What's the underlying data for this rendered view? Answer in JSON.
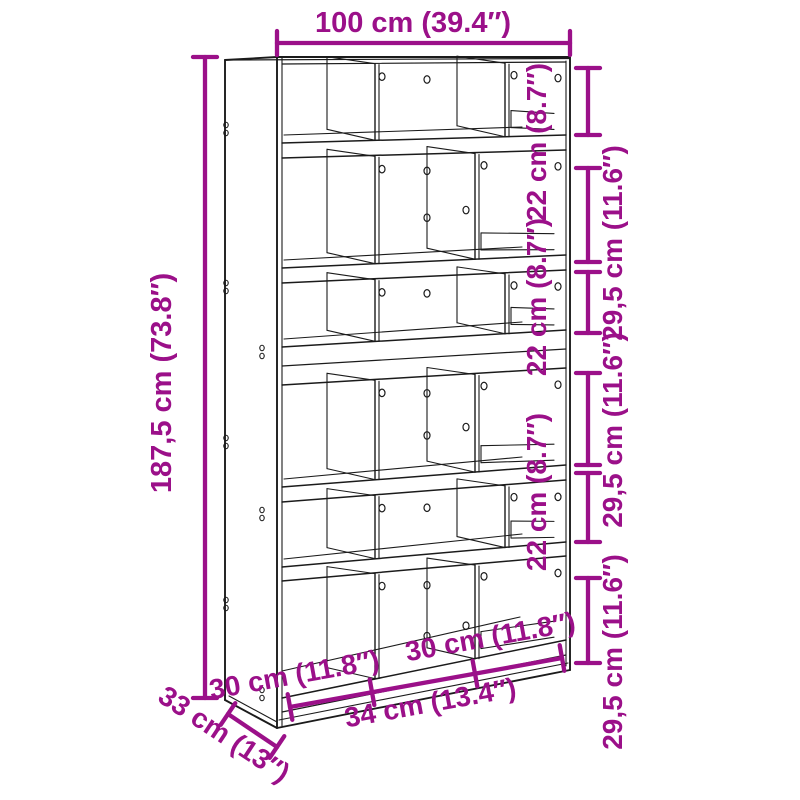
{
  "page": {
    "background": "#ffffff"
  },
  "colors": {
    "dimension_magenta": "#9B1089",
    "drawing_line": "#1b1b1b"
  },
  "diagram": {
    "type": "furniture-dimension-diagram",
    "subject": "bookcase room divider with staggered cubby compartments",
    "overall": {
      "width_top": {
        "label": "100 cm (39.4″)",
        "value_cm": 100
      },
      "height_left": {
        "label": "187,5 cm (73.8″)",
        "value_cm": 187.5
      },
      "depth_bottom_left": {
        "label": "33 cm (13″)",
        "value_cm": 33
      }
    },
    "right_side_segments": [
      {
        "label": "22 cm (8.7″)",
        "value_cm": 22
      },
      {
        "label": "29,5 cm (11.6″)",
        "value_cm": 29.5
      },
      {
        "label": "22 cm (8.7″)",
        "value_cm": 22
      },
      {
        "label": "29,5 cm (11.6″)",
        "value_cm": 29.5
      },
      {
        "label": "22 cm (8.7″)",
        "value_cm": 22
      },
      {
        "label": "29,5 cm (11.6″)",
        "value_cm": 29.5
      }
    ],
    "bottom_segments": [
      {
        "label": "30 cm (11.8″)",
        "value_cm": 30
      },
      {
        "label": "34 cm (13.4″)",
        "value_cm": 34
      },
      {
        "label": "30 cm (11.8″)",
        "value_cm": 30
      }
    ]
  }
}
